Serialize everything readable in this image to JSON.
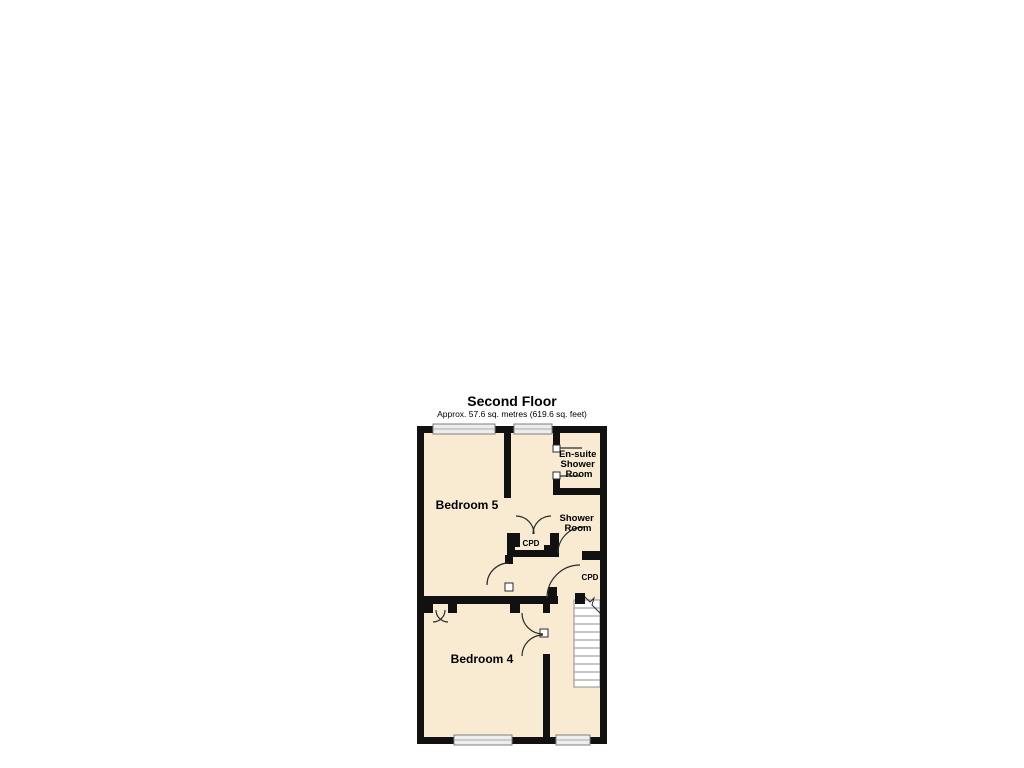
{
  "title": "Second Floor",
  "subtitle": "Approx. 57.6 sq. metres (619.6 sq. feet)",
  "rooms": {
    "bedroom5": {
      "label": "Bedroom 5"
    },
    "bedroom4": {
      "label": "Bedroom 4"
    },
    "ensuite": {
      "lines": [
        "En-suite",
        "Shower",
        "Room"
      ]
    },
    "shower_room": {
      "lines": [
        "Shower",
        "Room"
      ]
    },
    "cupboard_middle": {
      "label": "CPD"
    },
    "cupboard_landing": {
      "label": "CPD"
    }
  },
  "colors": {
    "bg": "#ffffff",
    "floor": "#f8ebd2",
    "wall": "#111111",
    "door": "#2b2b2b",
    "text": "#000000",
    "winfill": "#ededed",
    "winstroke": "#7f7f7f",
    "winline": "#aaaaaa",
    "stairfill": "#ffffff",
    "stairline": "#8c8c8c"
  }
}
